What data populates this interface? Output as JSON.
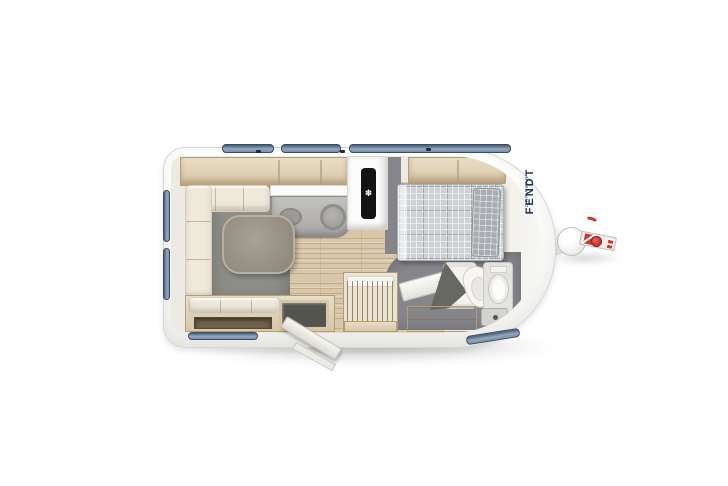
{
  "brand": {
    "name": "FENDT",
    "subtitle": "CARAVAN"
  },
  "fridge": {
    "snowflakes": [
      "❄",
      "❄",
      "❄"
    ]
  },
  "colors": {
    "body": "#fbfbfa",
    "body_edge": "#d6d6d2",
    "wood": "#d7c6a7",
    "wood_dark": "#b49e79",
    "wood_light": "#e8decা7",
    "wood_light_fix": "#e8dec7",
    "counter": "#b3b2ae",
    "carpet": "#8f8f89",
    "floor_grey": "#85858a",
    "laminate": "#d9c7a9",
    "cushion": "#efe9dc",
    "table": "#9d968b",
    "bedding": "#cdd1d4",
    "bedding_dark": "#a9adb3",
    "window": "#8fa6bf",
    "window_dark": "#47586f",
    "navy": "#233457",
    "red": "#cc372e",
    "dark_unit": "#54544f"
  }
}
